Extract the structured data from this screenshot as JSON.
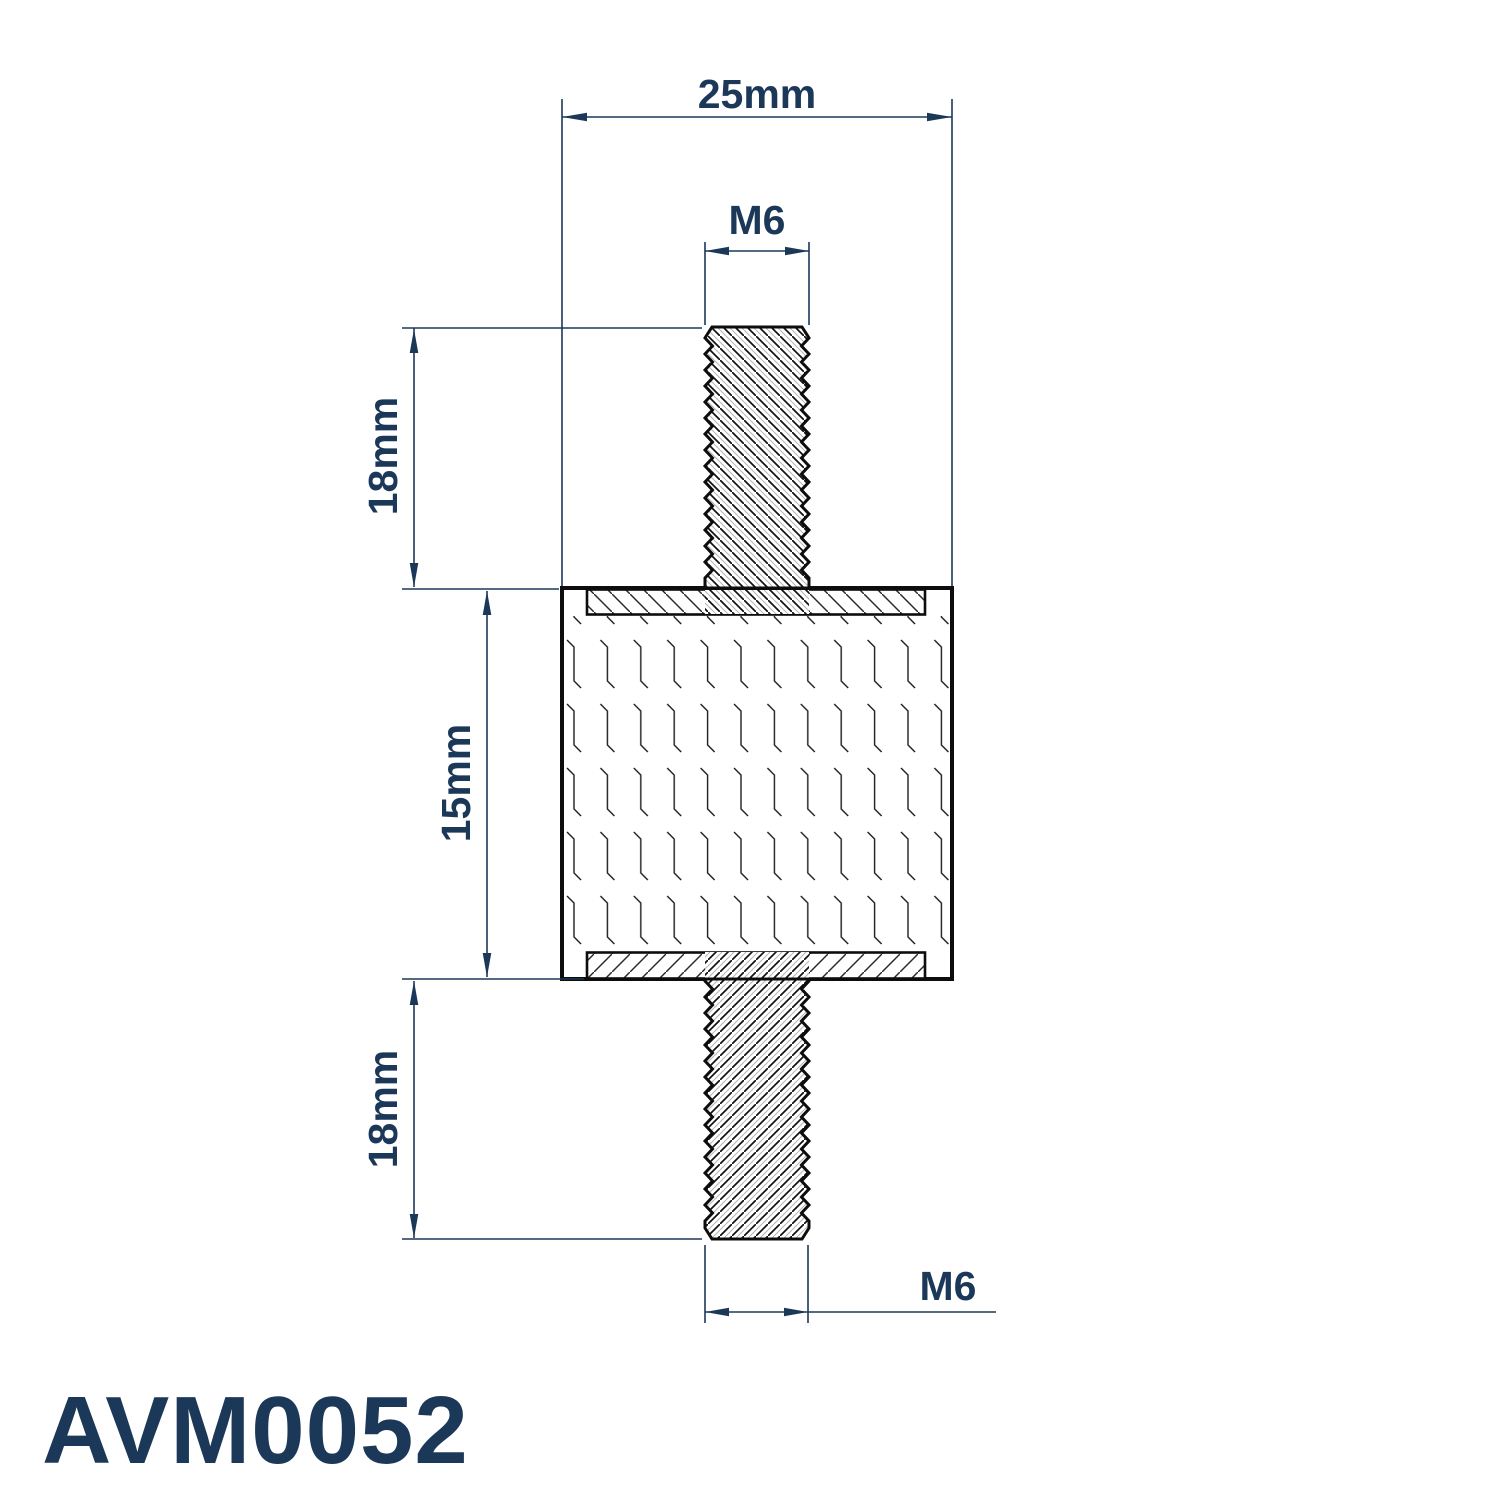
{
  "drawing": {
    "part_number": "AVM0052",
    "dimensions": {
      "overall_width": "25mm",
      "top_thread": "M6",
      "top_stud_length": "18mm",
      "body_height": "15mm",
      "bottom_stud_length": "18mm",
      "bottom_thread": "M6"
    },
    "colors": {
      "dimension_color": "#1c3859",
      "outline_color": "#0d0d0d",
      "background": "#ffffff"
    }
  }
}
